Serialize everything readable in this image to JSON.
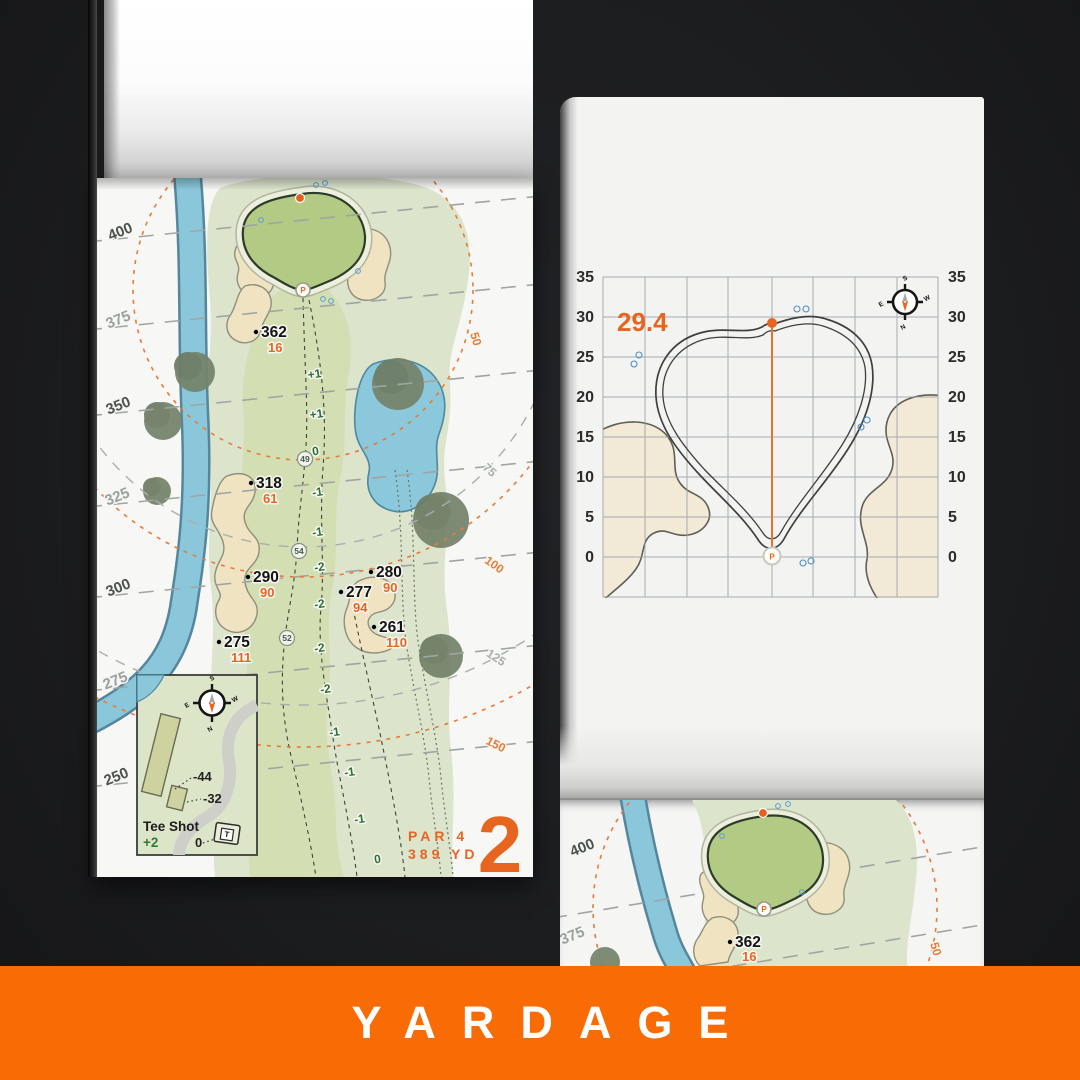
{
  "banner": {
    "label": "YARDAGE",
    "bg": "#f96b04"
  },
  "shared": {
    "pin": "P",
    "tee": "T",
    "compass": {
      "n": "N",
      "s": "S",
      "e": "E",
      "w": "W"
    }
  },
  "left_page": {
    "hole_number": "2",
    "par_label": "PAR 4",
    "length_label": "389 YD",
    "edge_yardages": [
      "400",
      "375",
      "350",
      "325",
      "300",
      "275",
      "250"
    ],
    "arc_labels_orange": [
      "50",
      "100",
      "150"
    ],
    "arc_labels_gray": [
      "75",
      "125"
    ],
    "points": [
      {
        "dist": "362",
        "to_green": "16"
      },
      {
        "dist": "318",
        "to_green": "61"
      },
      {
        "dist": "290",
        "to_green": "90"
      },
      {
        "dist": "280",
        "to_green": "90"
      },
      {
        "dist": "277",
        "to_green": "94"
      },
      {
        "dist": "261",
        "to_green": "110"
      },
      {
        "dist": "275",
        "to_green": "111"
      }
    ],
    "centerline": [
      "+1",
      "+1",
      "0",
      "-1",
      "-1",
      "-2",
      "-2",
      "-2",
      "-2",
      "-1",
      "-1",
      "-1",
      "0"
    ],
    "width_circles": [
      "49",
      "54",
      "52"
    ],
    "tee_inset": {
      "title": "Tee Shot",
      "score": "+2",
      "zero": "0",
      "back": "-44",
      "mid": "-32"
    }
  },
  "right_page": {
    "pin_distance": "29.4",
    "y_ticks": [
      "35",
      "30",
      "25",
      "20",
      "15",
      "10",
      "5",
      "0"
    ]
  },
  "third_page": {
    "edge_yardages": [
      "400",
      "375"
    ],
    "point": {
      "dist": "362",
      "to_green": "16"
    },
    "arc_label": "50"
  },
  "chart_data": {
    "type": "line",
    "title": "Green depth grid (yards)",
    "ylabel": "yards from front of green",
    "y_axis_ticks": [
      0,
      5,
      10,
      15,
      20,
      25,
      30,
      35
    ],
    "pin_to_back_depth": 29.4,
    "series": [
      {
        "name": "green outline depth at pin line",
        "values": [
          0,
          29.4
        ]
      }
    ]
  }
}
